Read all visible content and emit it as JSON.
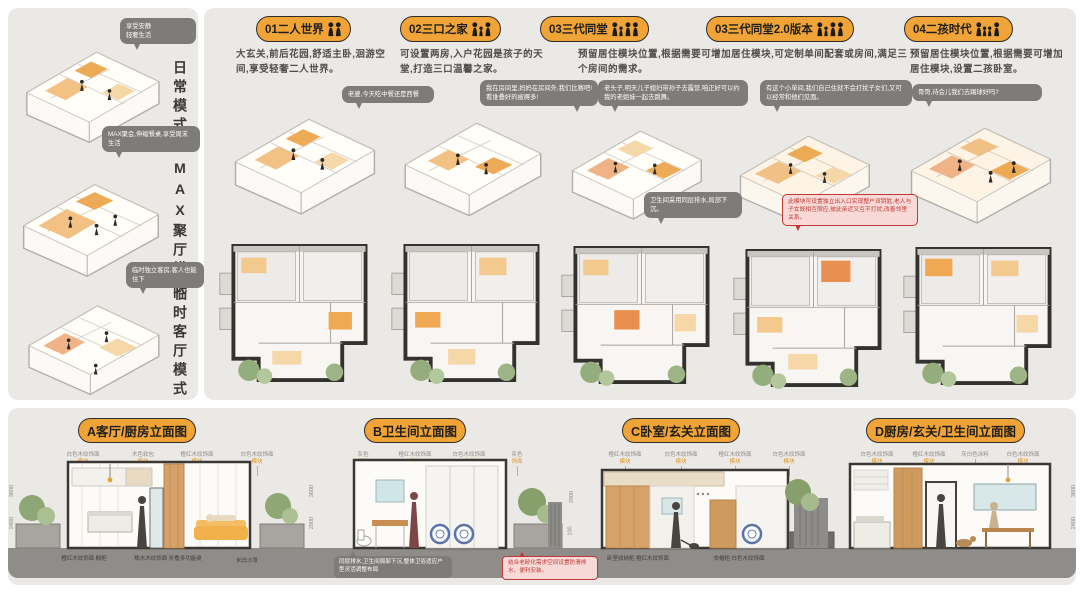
{
  "colors": {
    "accent_yellow": "#F0A437",
    "bubble_gray": "#7E7C79",
    "note_red": "#C03A33",
    "wood": "#D7A269",
    "ground": "#8F8D8A"
  },
  "left_panel": {
    "modes": [
      {
        "bubble": "享受安静\n轻奢生活",
        "label": "日常模式"
      },
      {
        "bubble": "MAX聚会,伸缩餐桌,享受周末生活",
        "label": "MAX聚厅模式"
      },
      {
        "bubble": "临时独立客房,客人也能住下",
        "label": "临时客厅模式"
      }
    ]
  },
  "scenarios": [
    {
      "badge": "01二人世界",
      "desc": "大玄关,前后花园,舒适主卧,洄游空间,享受轻奢二人世界。"
    },
    {
      "badge": "02三口之家",
      "desc": "可设置两房,入户花园是孩子的天堂,打造三口温馨之家。",
      "bubble1": "老婆,今天吃中餐还是西餐",
      "bubble2": "我在房间里,妈妈在房间外,我们比赛吧!看谁叠好的被褥多!"
    },
    {
      "badge": "03三代同堂",
      "desc": "预留居住模块位置,根据需要可增加居住模块,可定制单间配套或房间,满足三个房间的需求。",
      "bubble1": "老头子,明天儿子媳妇带孙子去露营,咱正好可以约我的老姐妹一起去跳舞。",
      "note": "卫生间采用同层排水,局部下沉。"
    },
    {
      "badge": "03三代同堂2.0版本",
      "bubble1": "有这个小单间,我们自己住就不会打扰子女们,又可以经常和他们见面。",
      "note": "此模块可设置独立出入口实现整户双钥匙,老人与子女既相互照应,彼此亲近又互不打扰,改善邻里关系。"
    },
    {
      "badge": "04二孩时代",
      "desc": "预留居住模块位置,根据需要可增加居住模块,设置二孩卧室。",
      "bubble1": "哥哥,待会儿我们去踢球好吗?"
    }
  ],
  "elevations": [
    {
      "title": "A客厅/厨房立面图",
      "top_labels": [
        {
          "t": "白色木纹饰面",
          "s": "模块"
        },
        {
          "t": "木色软包",
          "s": "模块"
        },
        {
          "t": "橙红木纹饰面",
          "s": "模块"
        },
        {
          "t": "白色木纹饰面",
          "s": "模块"
        }
      ],
      "bottom_labels": [
        "橙红木纹饰面 橱柜",
        "橡木木纹饰面 折叠多功能桌",
        "米白沙发"
      ],
      "dims": [
        "3600",
        "2400"
      ]
    },
    {
      "title": "B卫生间立面图",
      "top_labels": [
        {
          "t": "灰色",
          "s": "饰面"
        },
        {
          "t": "橙红木纹饰面",
          "s": "模块"
        },
        {
          "t": "白色木纹饰面",
          "s": "柜体"
        },
        {
          "t": "灰色",
          "s": "饰面"
        }
      ],
      "notes": {
        "gray": "同层排水,卫生间局部下沉,整体卫浴适应户型灵活调整布局",
        "pink": "结合老龄化需求空间设置防滑排水、便利安装。"
      },
      "dims": [
        "3600",
        "2900"
      ]
    },
    {
      "title": "C卧室/玄关立面图",
      "top_labels": [
        {
          "t": "橙红木纹饰面",
          "s": "模块"
        },
        {
          "t": "白色木纹饰面",
          "s": "模块"
        },
        {
          "t": "橙红木纹饰面",
          "s": "模块"
        },
        {
          "t": "白色木纹饰面",
          "s": "模块"
        }
      ],
      "bottom_labels": [
        "卧室收纳柜 橙红木纹饰面",
        "衣帽柜 白色木纹饰面"
      ],
      "dims": [
        "2900",
        "100"
      ]
    },
    {
      "title": "D厨房/玄关/卫生间立面图",
      "top_labels": [
        {
          "t": "白色木纹饰面",
          "s": "模块"
        },
        {
          "t": "橙红木纹饰面",
          "s": "模块"
        },
        {
          "t": "灰白色涂料",
          "s": ""
        },
        {
          "t": "白色木纹饰面",
          "s": "模块"
        }
      ],
      "dims": [
        "3600",
        "2400"
      ]
    }
  ]
}
